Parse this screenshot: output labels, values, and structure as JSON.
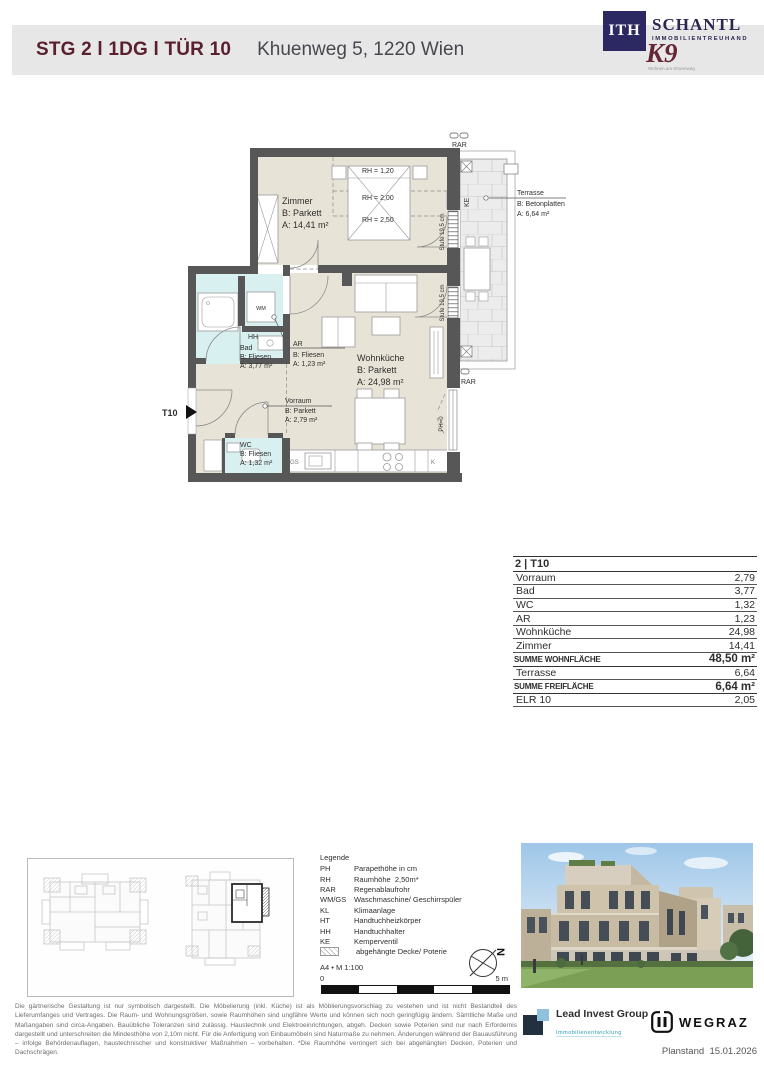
{
  "header": {
    "title": "STG 2 l 1DG l TÜR 10",
    "address": "Khuenweg 5, 1220 Wien",
    "brand": {
      "ith": "ITH",
      "schantl": "SCHANTL",
      "schantl_sub": "IMMOBILIENTREUHAND",
      "k9": "K9",
      "k9_sub": "Wohnen am Khuenweg"
    }
  },
  "plan": {
    "rooms": {
      "zimmer": {
        "name": "Zimmer",
        "b": "B: Parkett",
        "a": "A: 14,41 m²"
      },
      "wohnkueche": {
        "name": "Wohnküche",
        "b": "B: Parkett",
        "a": "A: 24,98 m²"
      },
      "bad": {
        "name": "Bad",
        "b": "B: Fliesen",
        "a": "A: 3,77 m²"
      },
      "ar": {
        "name": "AR",
        "b": "B: Fliesen",
        "a": "A: 1,23 m²"
      },
      "vorraum": {
        "name": "Vorraum",
        "b": "B: Parkett",
        "a": "A: 2,79 m²"
      },
      "wc": {
        "name": "WC",
        "b": "B: Fliesen",
        "a": "A: 1,32 m²"
      },
      "terrasse": {
        "name": "Terrasse",
        "b": "B: Betonplatten",
        "a": "A: 6,64 m²"
      }
    },
    "rh": {
      "rh1": "RH = 1,20",
      "rh2": "RH = 2,00",
      "rh3": "RH = 2,50"
    },
    "ann": {
      "t10": "T10",
      "rar": "RAR",
      "ke": "KE",
      "stufe": "Stufe 19,5 cm",
      "ph0": "PH=0",
      "wm": "WM",
      "hh": "HH",
      "gs": "GS",
      "k": "K"
    }
  },
  "table": {
    "title": "2 | T10",
    "rows": [
      {
        "label": "Vorraum",
        "value": "2,79"
      },
      {
        "label": "Bad",
        "value": "3,77"
      },
      {
        "label": "WC",
        "value": "1,32"
      },
      {
        "label": "AR",
        "value": "1,23"
      },
      {
        "label": "Wohnküche",
        "value": "24,98"
      },
      {
        "label": "Zimmer",
        "value": "14,41"
      },
      {
        "label": "SUMME WOHNFLÄCHE",
        "value": "48,50 m²"
      },
      {
        "label": "Terrasse",
        "value": "6,64"
      },
      {
        "label": "SUMME FREIFLÄCHE",
        "value": "6,64 m²"
      },
      {
        "label": "ELR 10",
        "value": "2,05"
      }
    ]
  },
  "legend": {
    "title": "Legende",
    "items": [
      {
        "term": "PH",
        "def": "Parapethöhe in cm"
      },
      {
        "term": "RH",
        "def": "Raumhöhe  2,50m*"
      },
      {
        "term": "RAR",
        "def": "Regenablaufrohr"
      },
      {
        "term": "WM/GS",
        "def": "Waschmaschine/ Geschirrspüler"
      },
      {
        "term": "KL",
        "def": "Klimaanlage"
      },
      {
        "term": "HT",
        "def": "Handtuchheizkörper"
      },
      {
        "term": "HH",
        "def": "Handtuchhalter"
      },
      {
        "term": "KE",
        "def": "Kemperventil"
      },
      {
        "term": "",
        "def": "abgehängte Decke/ Poterie"
      }
    ],
    "format": "A4 • M 1:100",
    "scale_start": "0",
    "scale_end": "5 m",
    "north": "N"
  },
  "footer": {
    "disclaimer": "Die gärtnerische Gestaltung ist nur symbolisch dargestellt. Die Möbelierung (inkl. Küche) ist als Möblierungsvorschlag zu vestehen und ist nicht Bestandteil des Lieferumfanges und Vertrages. Die Raum- und Wohnungsgrößen, sowie Raumhöhen sind ungfähre Werte und können sich noch geringfügig ändern. Sämtliche Maße und Maßangaben sind circa-Angaben. Bauübliche Toleranzen sind zulässig. Haustechnik und Elektroeinrichtungen, abgeh. Decken sowie Poterien sind nur nach Erfordernis dargestellt und unterschreiten die Mindesthöhe von 2,10m nicht. Für die Anfertigung von Einbaumöbeln sind Naturmaße zu nehmen. Änderungen während der Bauausführung – infolge Behördenauflagen, haustechnischer und konstruktiver Maßnahmen – vorbehalten.   *Die Raumhöhe verringert sich bei abgehängten Decken, Poterien und Dachschrägen.",
    "planstand": "Planstand  15.01.2026",
    "lead_invest": {
      "name": "Lead Invest Group",
      "sub": "Immobilienentwicklung"
    },
    "wegraz": "WEGRAZ"
  },
  "colors": {
    "brand_maroon": "#5a2030",
    "brand_navy": "#2b2862",
    "teal": "#2a9db5",
    "wall": "#575757",
    "parkett": "#e8e3d7",
    "fliesen": "#d9f0f1",
    "header_band": "#e7e7e7"
  }
}
